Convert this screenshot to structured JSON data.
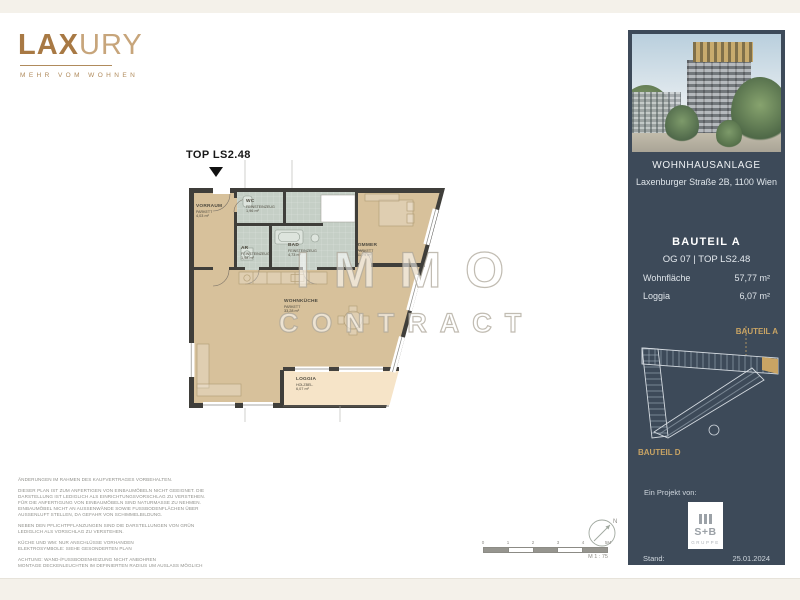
{
  "brand": {
    "name_bold": "LAX",
    "name_light": "URY",
    "tagline": "MEHR VOM WOHNEN",
    "color": "#a87944"
  },
  "plan": {
    "unit_marker": "TOP LS2.48",
    "watermark": {
      "line1": "IMMO",
      "line2": "CONTRACT"
    },
    "rooms": [
      {
        "id": "vorraum",
        "name": "VORRAUM",
        "floor": "PARKETT",
        "area": "4,03 m²"
      },
      {
        "id": "wc",
        "name": "WC",
        "floor": "FEINSTEINZEUG",
        "area": "1,96 m²"
      },
      {
        "id": "ar",
        "name": "AR",
        "floor": "FEINSTEINZEUG",
        "area": "1,98 m²"
      },
      {
        "id": "bad",
        "name": "BAD",
        "floor": "FEINSTEINZEUG",
        "area": "4,73 m²"
      },
      {
        "id": "zimmer",
        "name": "ZIMMER",
        "floor": "PARKETT",
        "area": "11,79 m²"
      },
      {
        "id": "wohnkueche",
        "name": "WOHNKÜCHE",
        "floor": "PARKETT",
        "area": "33,28 m²"
      },
      {
        "id": "loggia",
        "name": "LOGGIA",
        "floor": "HOLZBEL.",
        "area": "6,07 m²"
      }
    ],
    "colors": {
      "wall": "#3f3e3a",
      "room": "#d7c19b",
      "wet": "#c5cfc6",
      "loggia": "#f6e4c8"
    }
  },
  "sidebar": {
    "bg": "#3d4a59",
    "accent": "#c9a464",
    "project_title": "WOHNHAUSANLAGE",
    "project_address": "Laxenburger Straße 2B, 1100 Wien",
    "bauteil": "BAUTEIL A",
    "floor_top": "OG 07 | TOP LS2.48",
    "stats": [
      {
        "label": "Wohnfläche",
        "value": "57,77 m²"
      },
      {
        "label": "Loggia",
        "value": "6,07 m²"
      }
    ],
    "siteplan": {
      "label_top": "BAUTEIL A",
      "label_bottom": "BAUTEIL D"
    },
    "project_by": "Ein Projekt von:",
    "partner_logo": {
      "line1": "S+B",
      "line2": "GRUPPE"
    },
    "stand_label": "Stand:",
    "stand_value": "25.01.2024"
  },
  "footer": {
    "disclaimers": [
      "ÄNDERUNGEN IM RAHMEN DES KAUFVERTRAGES VORBEHALTEN.",
      "DIESER PLAN IST ZUM ANFERTIGEN VON EINBAUMÖBELN NICHT GEEIGNET. DIE DARSTELLUNG IST LEDIGLICH ALS EINRICHTUNGSVORSCHLAG ZU VERSTEHEN. FÜR DIE ANFERTIGUNG VON EINBAUMÖBELN SIND NATURMASSE ZU NEHMEN. EINBAUMÖBEL NICHT AN AUSSENWÄNDE SOWIE FUSSBODENFLÄCHEN ÜBER AUSSENLUFT STELLEN, DA GEFAHR VON SCHIMMELBILDUNG.",
      "NEBEN DEN PFLICHTPFLANZUNGEN SIND DIE DARSTELLUNGEN VON GRÜN LEDIGLICH ALS VORSCHLAG ZU VERSTEHEN.",
      "KÜCHE UND WM: NUR ANSCHLÜSSE VORHANDEN\nELEKTROSYMBOLE: SIEHE GESONDERTEN PLAN",
      "ACHTUNG: WAND-/FUSSBODENHEIZUNG NICHT ANBOHREN\nMONTAGE DECKENLEUCHTEN IM DEFINIERTEN RADIUS UM AUSLASS MÖGLICH"
    ],
    "scale_ticks": [
      "0",
      "1",
      "2",
      "3",
      "4",
      "5M"
    ],
    "scale_label": "M 1 : 75",
    "north": "N"
  }
}
